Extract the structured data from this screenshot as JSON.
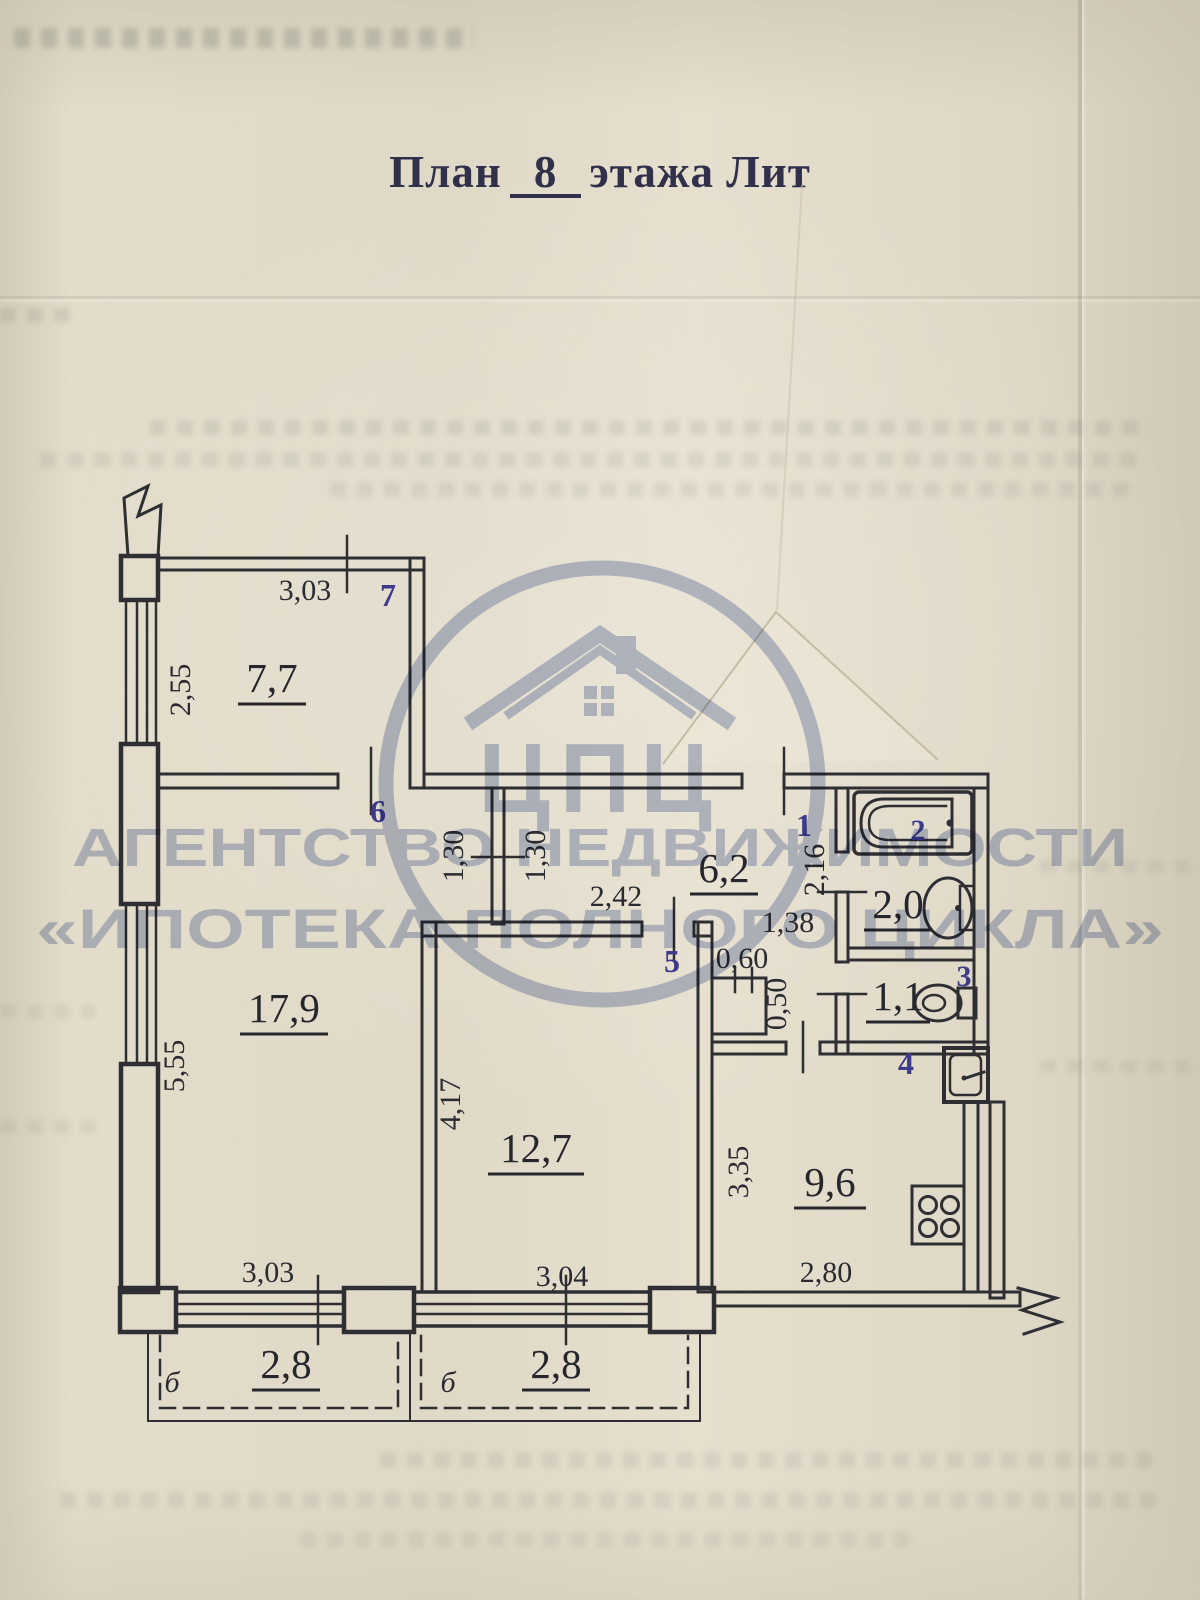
{
  "document": {
    "title": {
      "prefix": "План",
      "floor_number": "8",
      "suffix": "этажа Лит"
    }
  },
  "watermark": {
    "monogram": "ЦПЦ",
    "line1": "АГЕНТСТВО НЕДВИЖИМОСТИ",
    "line2": "«ИПОТЕКА ПОЛНОГО ЦИКЛА»",
    "color": "#7d90bf"
  },
  "plan": {
    "areas": {
      "room7": "7,7",
      "room17": "17,9",
      "room12": "12,7",
      "hallway": "6,2",
      "bathroom": "2,0",
      "toilet": "1,1",
      "kitchen": "9,6",
      "balcony1": "2,8",
      "balcony2": "2,8"
    },
    "room_numbers": {
      "r1": "1",
      "r2": "2",
      "r3": "3",
      "r4": "4",
      "r5": "5",
      "r6": "6",
      "r7": "7"
    },
    "dimensions": {
      "top_303": "3,03",
      "left_255": "2,55",
      "left_555": "5,55",
      "bottom_303": "3,03",
      "closet_130_a": "1,30",
      "closet_130_b": "1,30",
      "hall_242": "2,42",
      "bottom_304": "3,04",
      "room12_417": "4,17",
      "hall_138": "1,38",
      "hall_216": "2,16",
      "duct_060": "0,60",
      "duct_050": "0,50",
      "kitchen_335": "3,35",
      "kitchen_280": "2,80"
    },
    "balcony_letter_1": "б",
    "balcony_letter_2": "б"
  },
  "colors": {
    "paper": "#e0d9c7",
    "ink": "#2e2e33",
    "room_number_ink": "#3d3a8c",
    "watermark": "#7d90bf"
  }
}
